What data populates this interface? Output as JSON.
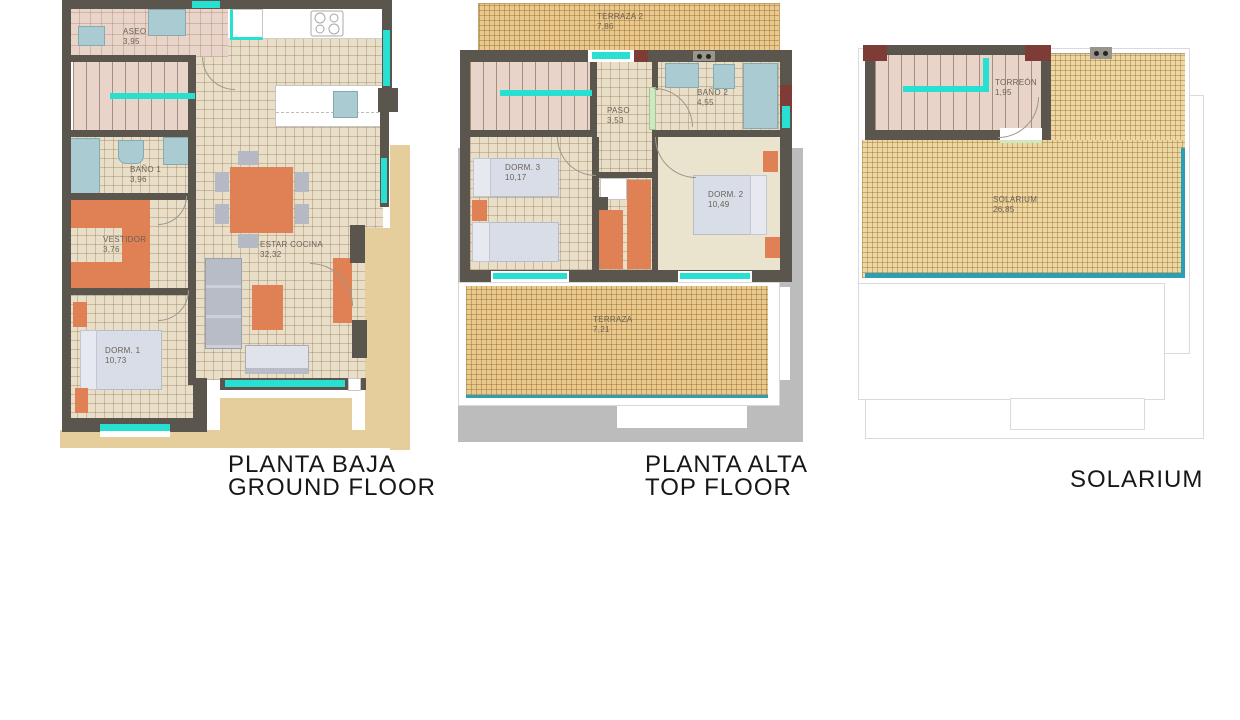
{
  "palette": {
    "wall": "#5a564e",
    "wall_accent": "#7d3c36",
    "floor_beige": "#e9dfc8",
    "floor_pink": "#e9d4c9",
    "terrace_tan": "#eac98e",
    "sand_background": "#e6cd9c",
    "shadow_gray": "#bcbcbc",
    "window_cyan": "#27e0d2",
    "pool_teal": "#2d9fb2",
    "furniture_orange": "#e08155",
    "furniture_gray": "#b4b9c4",
    "fixture_blue": "#a9cbd1",
    "bed_light": "#d8dde7"
  },
  "plans": {
    "ground": {
      "title": "PLANTA BAJA",
      "subtitle": "GROUND FLOOR",
      "rooms": {
        "aseo": {
          "name": "ASEO",
          "area": "3,95"
        },
        "bano1": {
          "name": "BAÑO 1",
          "area": "3,96"
        },
        "vestidor": {
          "name": "VESTIDOR",
          "area": "3,76"
        },
        "dorm1": {
          "name": "DORM. 1",
          "area": "10,73"
        },
        "estar": {
          "name": "ESTAR COCINA",
          "area": "32,32"
        }
      }
    },
    "top": {
      "title": "PLANTA ALTA",
      "subtitle": "TOP FLOOR",
      "rooms": {
        "terraza2": {
          "name": "TERRAZA 2",
          "area": "7,86"
        },
        "paso": {
          "name": "PASO",
          "area": "3,53"
        },
        "bano2": {
          "name": "BAÑO 2",
          "area": "4,55"
        },
        "dorm3": {
          "name": "DORM. 3",
          "area": "10,17"
        },
        "dorm2": {
          "name": "DORM. 2",
          "area": "10,49"
        },
        "terraza": {
          "name": "TERRAZA",
          "area": "7,21"
        }
      }
    },
    "solarium": {
      "title": "SOLARIUM",
      "rooms": {
        "torreon": {
          "name": "TORREÓN",
          "area": "1,95"
        },
        "solarium": {
          "name": "SOLARIUM",
          "area": "26,85"
        }
      }
    }
  }
}
